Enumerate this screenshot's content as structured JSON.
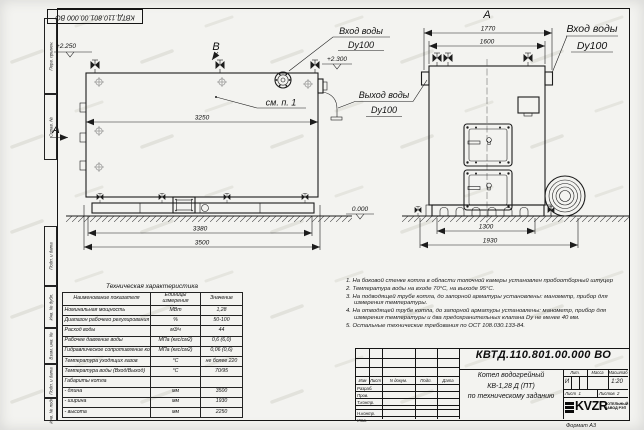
{
  "top_stamp": "КВТД.110.801.00.000  ВО",
  "frame_labels": {
    "perv_primen": "Перв. примен.",
    "sprav_no": "Справ. №",
    "podp_data1": "Подп. и дата",
    "inv_dubl": "Инв. № дубл.",
    "vzam_inv": "Взам. инв. №",
    "podp_data2": "Подп. и дата",
    "inv_podl": "Инв. № подл.",
    "format": "Формат А3"
  },
  "side_view": {
    "section_b": "B",
    "section_a": "A",
    "elev_top": "+2.250",
    "elev_out": "+2.300",
    "elev_zero": "0.000",
    "see_note": "см. п. 1",
    "inlet_label1": "Вход воды",
    "inlet_label2": "Dy100",
    "outlet_label1": "Выход воды",
    "outlet_label2": "Dy100",
    "dim_top": "3250",
    "dim_mid": "3380",
    "dim_bottom": "3500"
  },
  "front_view": {
    "view_label": "А",
    "dim_top1": "1770",
    "dim_top2": "1600",
    "inlet_label1": "Вход воды",
    "inlet_label2": "Dy100",
    "dim_bot1": "1300",
    "dim_bot2": "1930"
  },
  "tech_table": {
    "title": "Техническая характеристика",
    "headers": [
      "Наименование показателя",
      "Единицы измерения",
      "Значение"
    ],
    "rows": [
      [
        "Номинальная мощность",
        "МВт",
        "1,28"
      ],
      [
        "Диапазон рабочего регулирования",
        "%",
        "50-100"
      ],
      [
        "Расход воды",
        "м3/ч",
        "44"
      ],
      [
        "Рабочее давление воды",
        "МПа (кгс/см2)",
        "0,6 (6,0)"
      ],
      [
        "Гидравлическое сопротивление котла",
        "МПа (кгс/см2)",
        "0,06 (0,6)"
      ],
      [
        "Температура уходящих газов",
        "°С",
        "не более 220"
      ],
      [
        "Температура воды (Вход/Выход)",
        "°С",
        "70/95"
      ],
      [
        "Габариты котла",
        "",
        ""
      ],
      [
        "   - длина",
        "мм",
        "3500"
      ],
      [
        "   - ширина",
        "мм",
        "1930"
      ],
      [
        "   - высота",
        "мм",
        "2250"
      ]
    ]
  },
  "notes": [
    "1.  На боковой стенке котла в области топочной камеры установлен пробоотборный штуцер",
    "2.  Температура воды на входе 70°С, на выходе 95°С.",
    "3.  На подводящей трубе котла, до запорной арматуры установлены: манометр, прибор для измерения температуры.",
    "4.  На отводящей трубе котла, до запорной арматуры установлены: манометр, прибор для измерения температуры и два предохранительных клапана Dу не менее 40 мм.",
    "5.  Остальные технические требования по ОСТ 108.030.133-84."
  ],
  "title_block": {
    "doc_number": "КВТД.110.801.00.000  ВО",
    "header_cols": [
      "Изм",
      "Лист",
      "N докум.",
      "Подп.",
      "Дата"
    ],
    "sign_rows": [
      "Разраб.",
      "Пров.",
      "Т.контр.",
      "Н.контр.",
      "Утв."
    ],
    "product_line1": "Котел водогрейный",
    "product_line2": "КВ-1,28  Д  (ПТ)",
    "product_line3": "по техническому заданию",
    "lit_label": "Лит.",
    "mass_label": "Масса",
    "scale_label": "Масштаб",
    "lit_value": "И",
    "scale_value": "1:20",
    "sheet_label": "Лист",
    "sheet_num": "1",
    "sheets_label": "Листов",
    "sheets_num": "2",
    "logo_text": "KVZR",
    "org_line1": "КОТЕЛЬНЫЙ",
    "org_line2": "ЗАВОД РЭП"
  }
}
